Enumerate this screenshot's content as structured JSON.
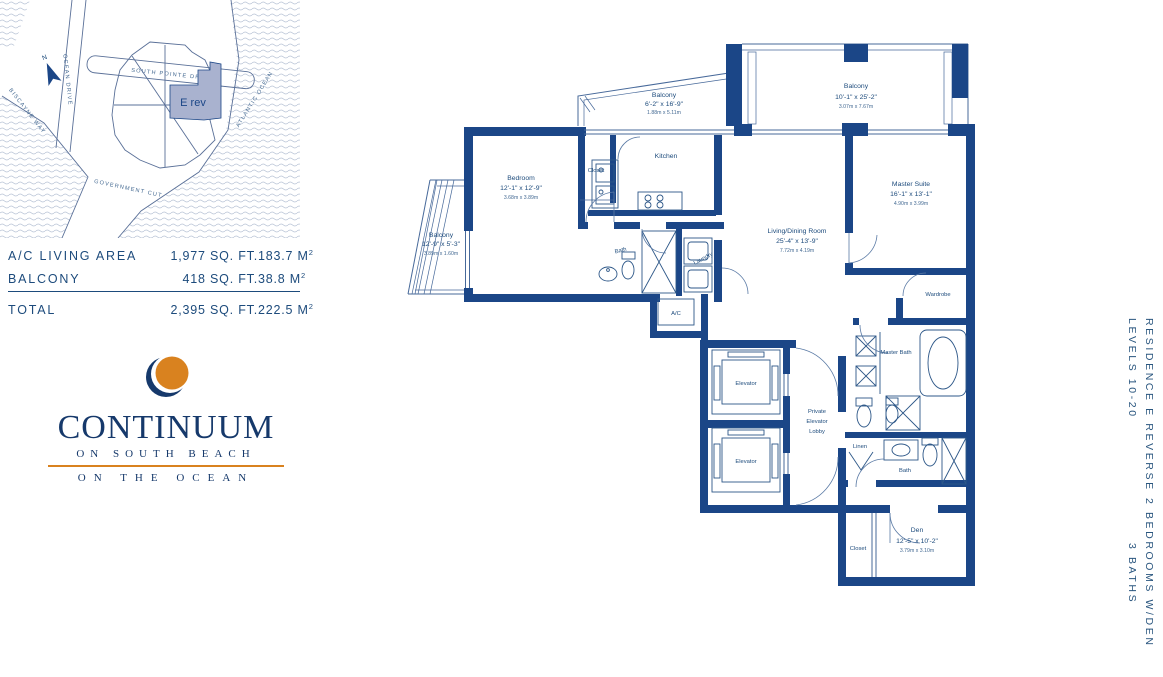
{
  "colors": {
    "navy": "#1b4687",
    "text_navy": "#1d4b7c",
    "orange": "#d9821f",
    "highlight": "#a9b2cf"
  },
  "site_map": {
    "south_pointe_drive": "SOUTH POINTE DRIVE",
    "ocean_drive": "OCEAN DRIVE",
    "biscayne_way": "BISCAYNE WAY",
    "atlantic_ocean": "ATLANTIC OCEAN",
    "government_cut": "GOVERNMENT CUT",
    "unit_highlight": "E rev",
    "north": "N"
  },
  "area_table": {
    "rows": [
      {
        "label": "A/C LIVING AREA",
        "sqft": "1,977 SQ. FT.",
        "sqm": "183.7 M",
        "sup": "2"
      },
      {
        "label": "BALCONY",
        "sqft": "418 SQ. FT.",
        "sqm": "38.8 M",
        "sup": "2"
      },
      {
        "label": "TOTAL",
        "sqft": "2,395 SQ. FT.",
        "sqm": "222.5 M",
        "sup": "2"
      }
    ]
  },
  "logo": {
    "name": "CONTINUUM",
    "tagline1": "ON SOUTH BEACH",
    "tagline2": "ON THE OCEAN"
  },
  "side_text": {
    "residence": "RESIDENCE E REVERSE",
    "levels": "LEVELS 10-20",
    "bedrooms": "2 BEDROOMS W/DEN",
    "baths": "3 BATHS"
  },
  "rooms": {
    "balcony_top_left": {
      "name": "Balcony",
      "imperial": "6'-2\" x 16'-9\"",
      "metric": "1.88m x 5.11m"
    },
    "balcony_top_right": {
      "name": "Balcony",
      "imperial": "10'-1\" x 25'-2\"",
      "metric": "3.07m x 7.67m"
    },
    "balcony_left": {
      "name": "Balcony",
      "imperial": "12'-9\" x 5'-3\"",
      "metric": "3.89m x 1.60m"
    },
    "bedroom": {
      "name": "Bedroom",
      "imperial": "12'-1\" x 12'-9\"",
      "metric": "3.68m x 3.89m"
    },
    "closet_bedroom": {
      "name": "Closet"
    },
    "kitchen": {
      "name": "Kitchen"
    },
    "bath": {
      "name": "Bath"
    },
    "laundry": {
      "name": "Laundry"
    },
    "ac": {
      "name": "A/C"
    },
    "living_dining": {
      "name": "Living/Dining Room",
      "imperial": "25'-4\" x 13'-9\"",
      "metric": "7.72m x 4.19m"
    },
    "master_suite": {
      "name": "Master Suite",
      "imperial": "16'-1\" x 13'-1\"",
      "metric": "4.90m x 3.99m"
    },
    "wardrobe": {
      "name": "Wardrobe"
    },
    "master_bath": {
      "name": "Master Bath"
    },
    "linen": {
      "name": "Linen"
    },
    "bath2": {
      "name": "Bath"
    },
    "elevator": {
      "name": "Elevator"
    },
    "lobby": {
      "line1": "Private",
      "line2": "Elevator",
      "line3": "Lobby"
    },
    "den": {
      "name": "Den",
      "imperial": "12'-5\" x 10'-2\"",
      "metric": "3.79m x 3.10m"
    },
    "closet_den": {
      "name": "Closet"
    }
  }
}
